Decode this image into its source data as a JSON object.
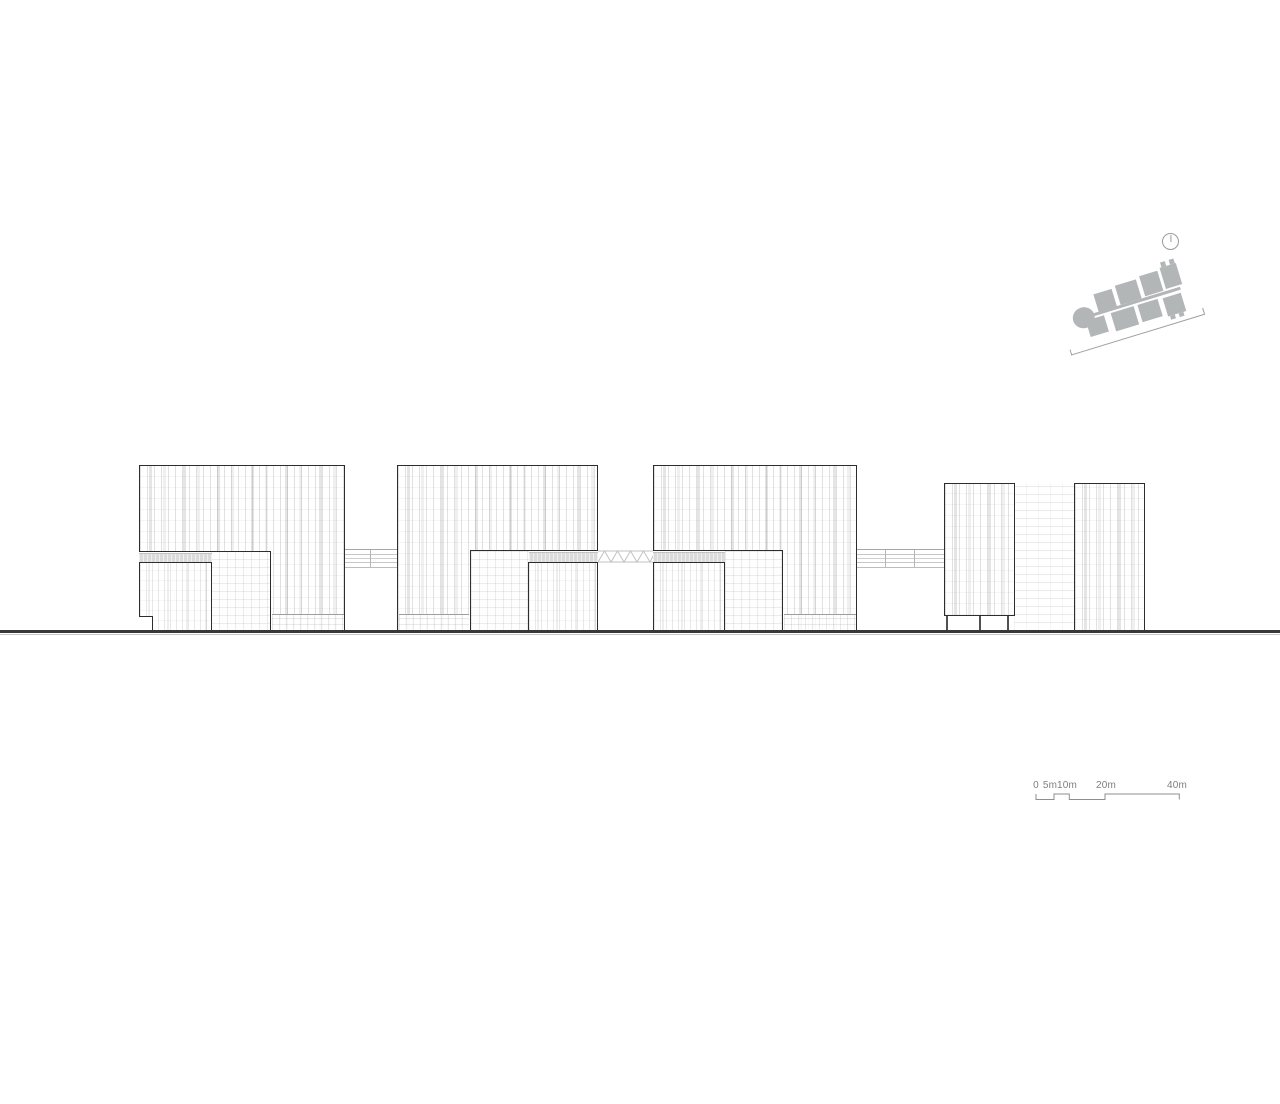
{
  "drawing": {
    "kind": "architectural building elevation",
    "building_clusters": 4,
    "link_bridges": 3
  },
  "scale_bar": {
    "labels": [
      "0",
      "5m",
      "10m",
      "20m",
      "40m"
    ]
  },
  "icons": {
    "north_arrow": "north-arrow-icon",
    "site_key": "site-key-plan"
  },
  "colors": {
    "background": "#ffffff",
    "building_outline": "#2d2d2d",
    "ground_line": "#383838",
    "annotation_gray": "#8f8f8f",
    "site_footprint_gray": "#b3b6b7",
    "facade_stripe_gray": "#c9c9c9"
  }
}
